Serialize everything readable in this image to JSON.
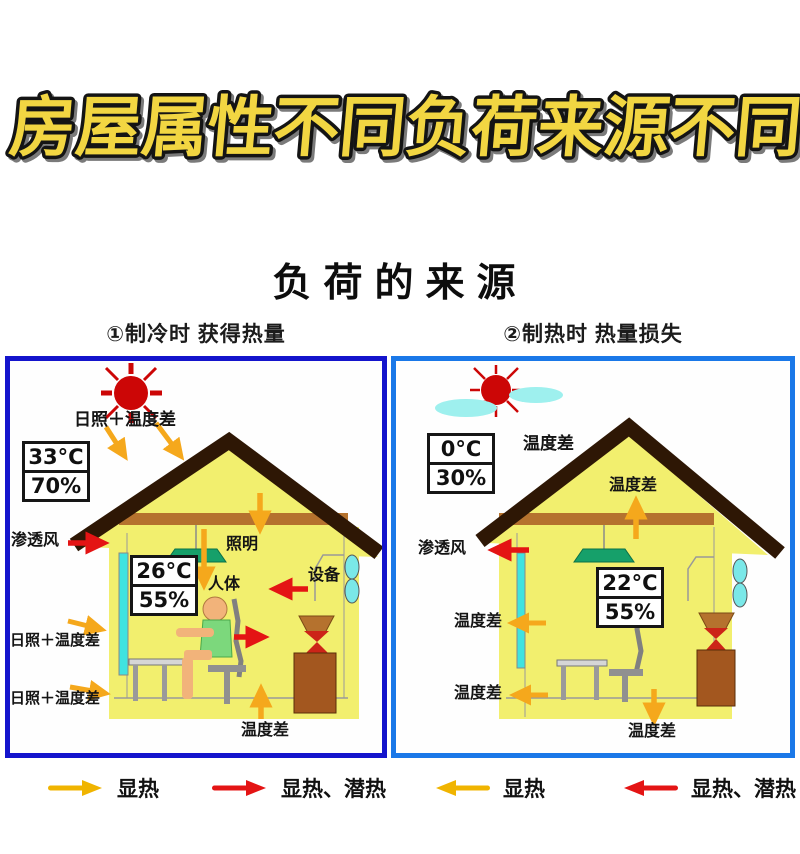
{
  "title": "房屋属性不同负荷来源不同",
  "subtitle": "负荷的来源",
  "panel_cooling": {
    "header": "①制冷时 获得热量",
    "outdoor_temp": "33°C",
    "outdoor_humidity": "70%",
    "indoor_temp": "26°C",
    "indoor_humidity": "55%",
    "label_solar_roof": "日照＋温度差",
    "label_infiltration": "渗透风",
    "label_lighting": "照明",
    "label_human": "人体",
    "label_equipment": "设备",
    "label_solar_wall_upper": "日照＋温度差",
    "label_solar_wall_lower": "日照＋温度差",
    "label_floor": "温度差"
  },
  "panel_heating": {
    "header": "②制热时 热量损失",
    "outdoor_temp": "0°C",
    "outdoor_humidity": "30%",
    "indoor_temp": "22°C",
    "indoor_humidity": "55%",
    "label_top": "温度差",
    "label_attic": "温度差",
    "label_infiltration": "渗透风",
    "label_wall_mid": "温度差",
    "label_wall_lower": "温度差",
    "label_floor": "温度差"
  },
  "legend": {
    "items": [
      {
        "arrow": "yellow-right-arrow",
        "label": "显热"
      },
      {
        "arrow": "red-right-arrow",
        "label": "显热、潜热"
      },
      {
        "arrow": "yellow-left-arrow",
        "label": "显热"
      },
      {
        "arrow": "red-left-arrow",
        "label": "显热、潜热"
      }
    ]
  },
  "colors": {
    "title_fill": "#f2d642",
    "title_outline": "#141414",
    "cooling_panel_border": "#1414cc",
    "heating_panel_border": "#1a78e8",
    "sensible_heat_arrow": "#f5a81c",
    "latent_heat_arrow": "#e41414",
    "wall_yellow": "#f2ef6e",
    "roof_brown": "#2e1705",
    "ceiling_brown": "#b5722e",
    "sun_red": "#cc0606",
    "window_cyan": "#3fe3e0",
    "cloud_cyan": "#9ef0ee",
    "lamp_green": "#16a06a"
  }
}
